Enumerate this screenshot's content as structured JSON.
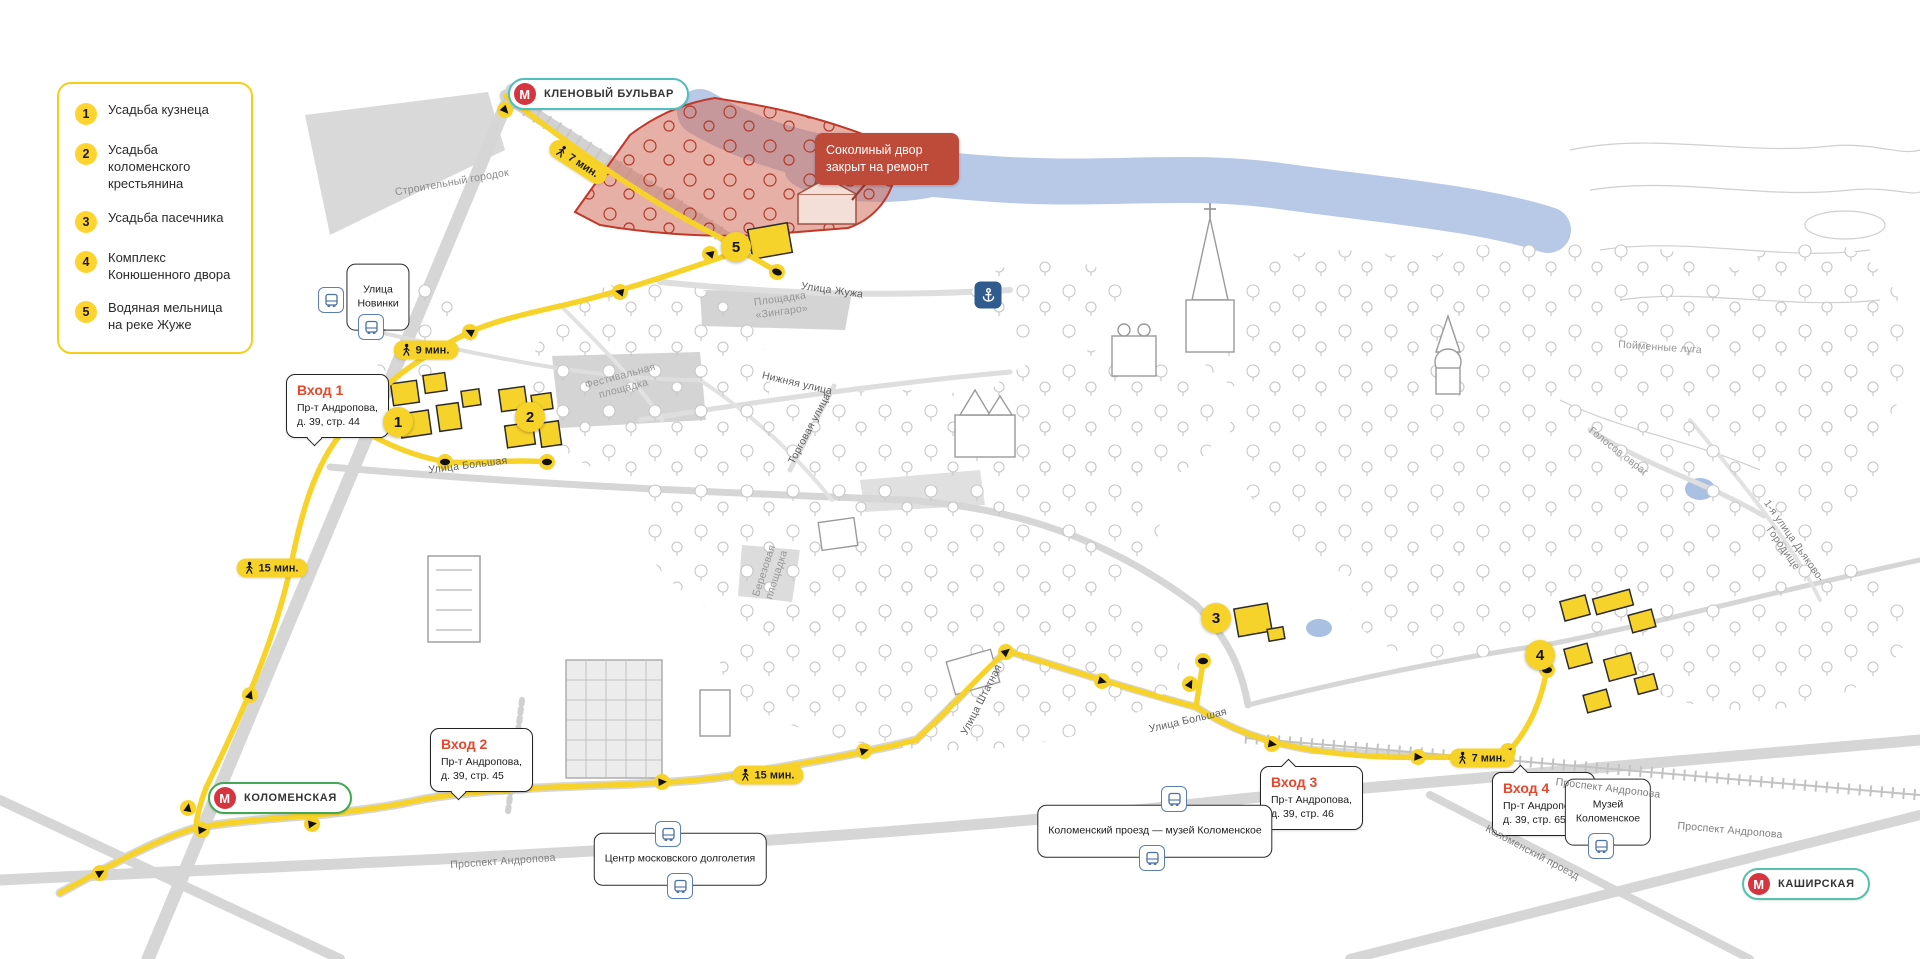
{
  "legend": {
    "items": [
      {
        "num": "1",
        "label": "Усадьба кузнеца"
      },
      {
        "num": "2",
        "label": "Усадьба коломенского крестьянина"
      },
      {
        "num": "3",
        "label": "Усадьба пасечника"
      },
      {
        "num": "4",
        "label": "Комплекс Конюшенного двора"
      },
      {
        "num": "5",
        "label": "Водяная мельница на реке Жуже"
      }
    ]
  },
  "metro": {
    "m_letter": "М",
    "stations": [
      {
        "name": "КЛЕНОВЫЙ БУЛЬВАР",
        "line_color": "#4FBFBF"
      },
      {
        "name": "КОЛОМЕНСКАЯ",
        "line_color": "#44A754"
      },
      {
        "name": "КАШИРСКАЯ",
        "line_color": "#56C2A9"
      }
    ]
  },
  "closure": {
    "text": "Соколиный двор\nзакрыт на ремонт"
  },
  "entrances": [
    {
      "title": "Вход 1",
      "address": "Пр-т Андропова,\nд. 39, стр. 44"
    },
    {
      "title": "Вход 2",
      "address": "Пр-т Андропова,\nд. 39, стр. 45"
    },
    {
      "title": "Вход 3",
      "address": "Пр-т Андропова,\nд. 39, стр. 46"
    },
    {
      "title": "Вход 4",
      "address": "Пр-т Андропова,\nд. 39, стр. 65"
    }
  ],
  "walk_badges": [
    {
      "label": "7 мин."
    },
    {
      "label": "9 мин."
    },
    {
      "label": "15 мин."
    },
    {
      "label": "15 мин."
    },
    {
      "label": "7 мин."
    }
  ],
  "markers": [
    {
      "num": "1"
    },
    {
      "num": "2"
    },
    {
      "num": "3"
    },
    {
      "num": "4"
    },
    {
      "num": "5"
    }
  ],
  "bubbles": [
    {
      "text": "Улица\nНовинки"
    },
    {
      "text": "Центр московского долголетия"
    },
    {
      "text": "Коломенский проезд — музей Коломенское"
    },
    {
      "text": "Музей\nКоломенское"
    }
  ],
  "streets": [
    {
      "text": "Строительный городок"
    },
    {
      "text": "Улица Жужа"
    },
    {
      "text": "Площадка\n«Зингаро»"
    },
    {
      "text": "Фестивальная\nплощадка"
    },
    {
      "text": "Нижняя улица"
    },
    {
      "text": "Торговая улица"
    },
    {
      "text": "Улица Большая"
    },
    {
      "text": "Березовая\nплощадка"
    },
    {
      "text": "Улица Штатная"
    },
    {
      "text": "Улица Большая"
    },
    {
      "text": "Проспект Андропова"
    },
    {
      "text": "Проспект Андропова"
    },
    {
      "text": "Проспект Андропова"
    },
    {
      "text": "Коломенский проезд"
    },
    {
      "text": "Пойменные луга"
    },
    {
      "text": "Голосов овраг"
    },
    {
      "text": "1-я улица Дьяково-Городище"
    }
  ],
  "colors": {
    "route_yellow": "#F7D32A",
    "closure_red": "#BE4A3A",
    "entrance_red": "#E2492F",
    "metro_red": "#D6353F",
    "water": "#B7C9E6",
    "closed_area_fill": "#D4705E"
  }
}
